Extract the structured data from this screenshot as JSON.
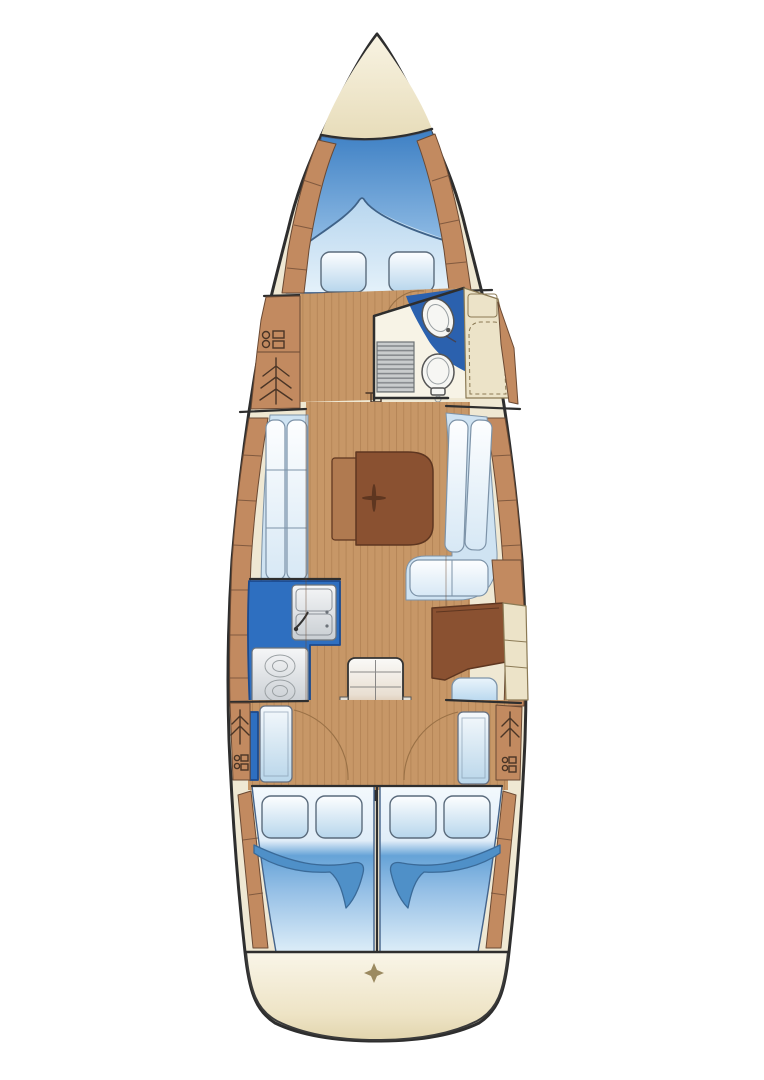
{
  "plan": {
    "type": "sailboat-interior-floor-plan",
    "orientation": "bow-at-top",
    "areas": [
      {
        "id": "anchor-locker"
      },
      {
        "id": "forward-v-berth",
        "pillows": 2
      },
      {
        "id": "port-forward-lockers",
        "symbols": [
          "cabinet-icon",
          "hanging-locker-icon"
        ]
      },
      {
        "id": "head-compartment",
        "fixtures": [
          "washbasin",
          "toilet",
          "shower-grate"
        ]
      },
      {
        "id": "starboard-wet-locker"
      },
      {
        "id": "saloon",
        "furniture": [
          "port-settee",
          "starboard-l-settee",
          "folding-table",
          "mast-step"
        ]
      },
      {
        "id": "galley",
        "fixtures": [
          "twin-sink",
          "two-burner-stove"
        ]
      },
      {
        "id": "nav-station",
        "furniture": [
          "chart-table",
          "navigator-seat"
        ]
      },
      {
        "id": "companionway",
        "fixtures": [
          "steps",
          "engine-box"
        ]
      },
      {
        "id": "aft-cabin-port",
        "pillows": 2
      },
      {
        "id": "aft-cabin-starboard",
        "pillows": 2
      },
      {
        "id": "stern-locker",
        "symbols": [
          "diamond-mark"
        ]
      }
    ],
    "colors": {
      "background": "#ffffff",
      "hullOutline": "#2e2e2e",
      "deck": "#efe8d3",
      "wood": "#c79767",
      "plankLine": "#ad7c50",
      "tan": "#c28a60",
      "tanLine": "#6b4a34",
      "creamPanel": "#ece3c8",
      "creamEdge": "#8b7a55",
      "counterBlue": "#2e6fc0",
      "counterEdge": "#1c4a8e",
      "headWallBlue": "#2b61ae",
      "fixtureWhite": "#f6f6f3",
      "fixtureEdge": "#555555",
      "grate": "#c9cccd",
      "grateLine": "#83878a",
      "tableBrown": "#8a5131",
      "tableLeaf": "#b07a50",
      "tableEdge": "#5e3620",
      "engineBrown": "#6f4028",
      "engineEdge": "#33200f",
      "foldBlue": "#4f90c8",
      "foldEdge": "#3a6a98",
      "bedOutline": "#44638a",
      "pillowEdge": "#5a6b7c",
      "cushionEdge": "#7d93a8",
      "setteeBlue": "#cfe3f2",
      "symbolInk": "#4a3526",
      "arcLine": "#9a7146",
      "sternEdge": "#3a3a3a"
    }
  }
}
